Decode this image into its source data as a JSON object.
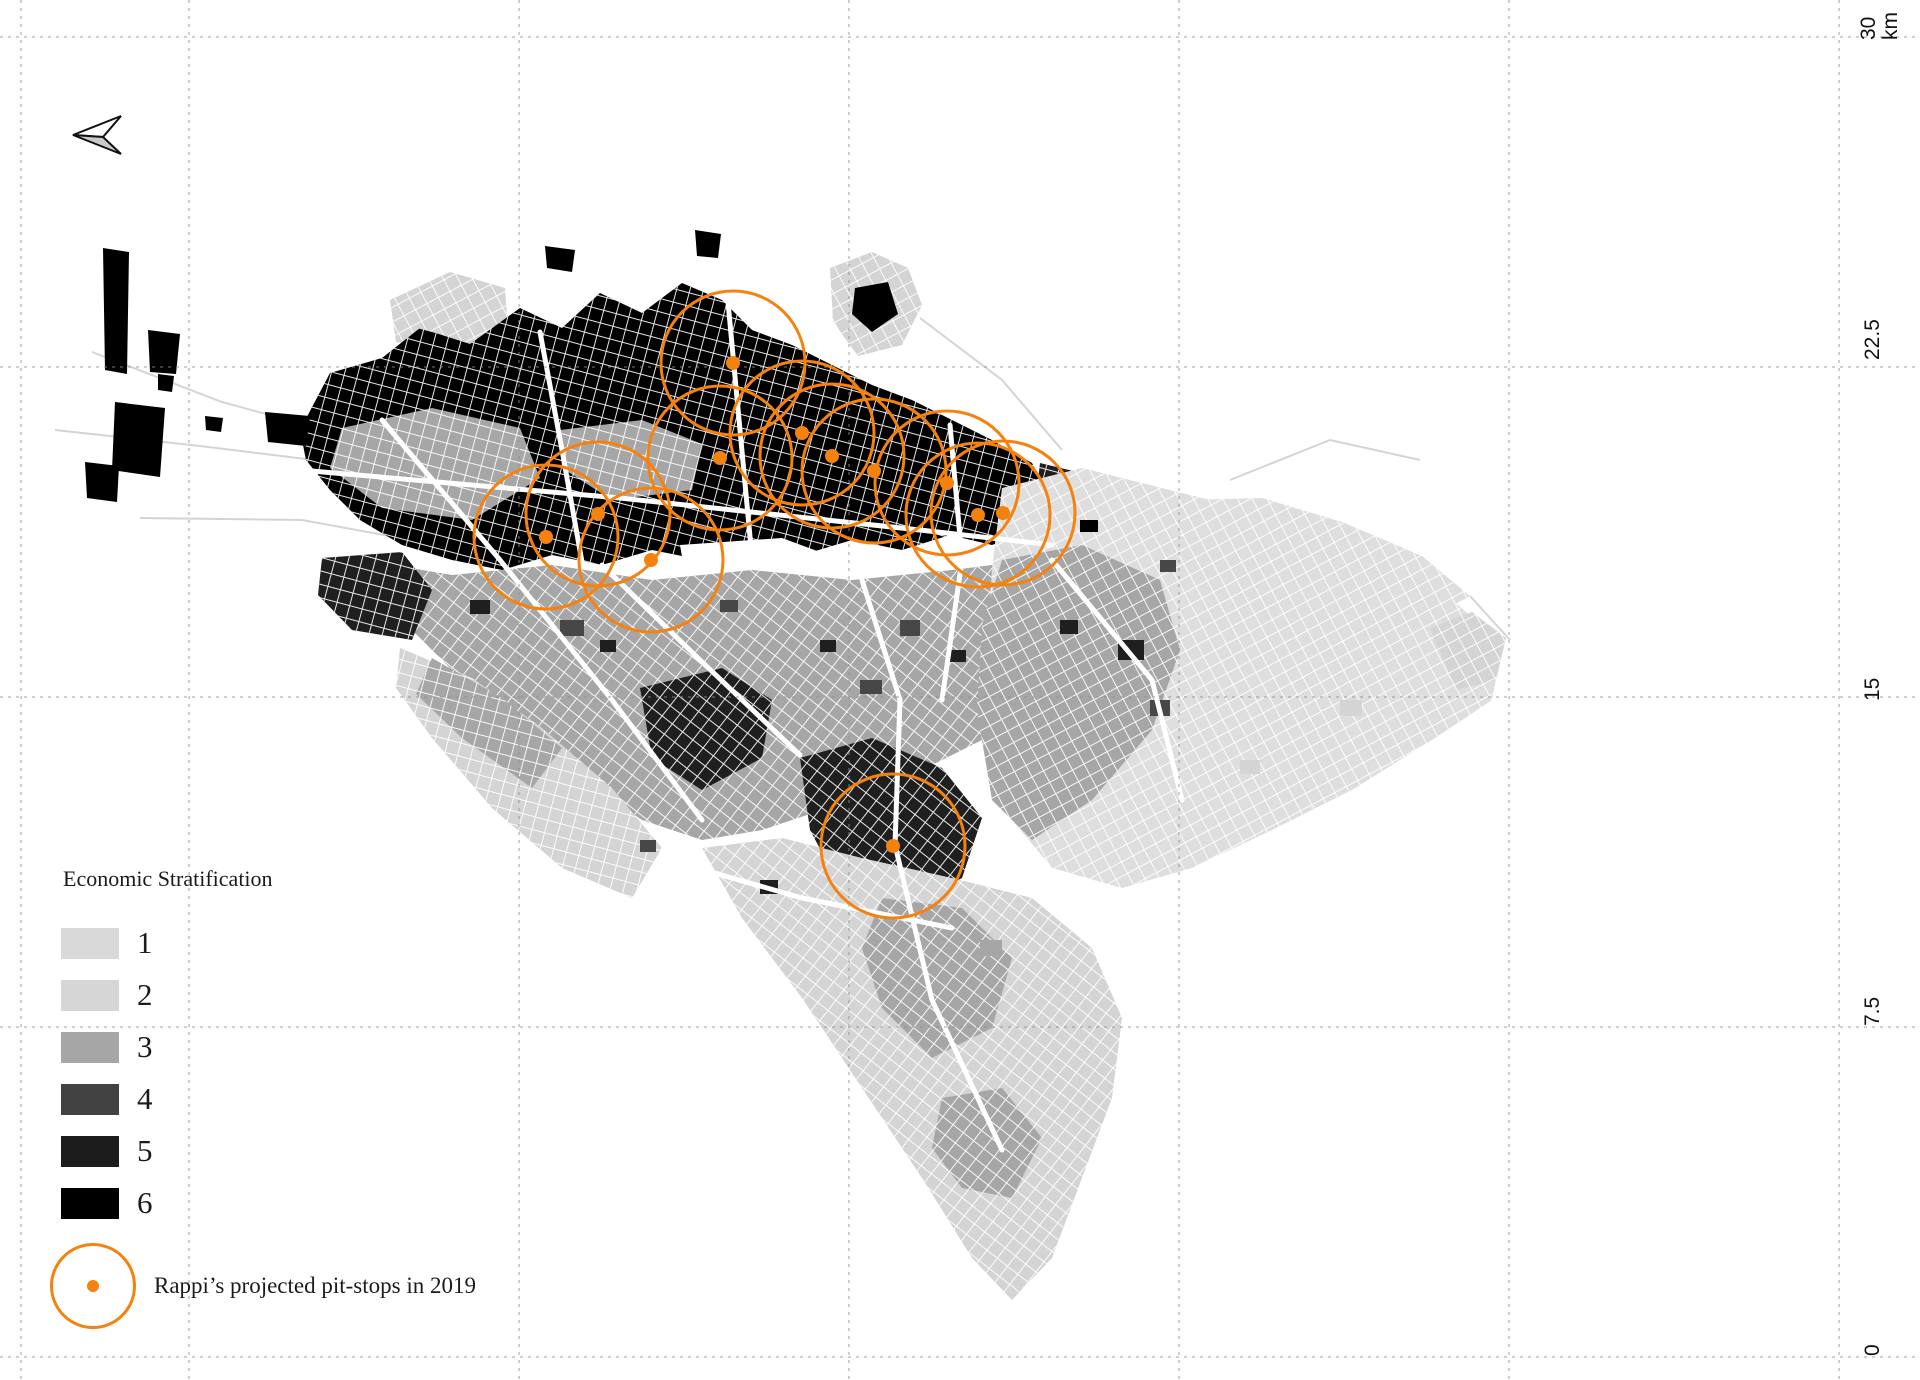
{
  "scale_bar": {
    "unit": "km",
    "ticks": [
      {
        "label": "30\nkm",
        "x": 1858,
        "y": 40
      },
      {
        "label": "22.5",
        "x": 1862,
        "y": 360
      },
      {
        "label": "15",
        "x": 1862,
        "y": 701
      },
      {
        "label": "7.5",
        "x": 1862,
        "y": 1026
      },
      {
        "label": "0",
        "x": 1862,
        "y": 1356
      }
    ]
  },
  "grid": {
    "color": "#8f8f8f",
    "dash": "3 5",
    "h_lines": [
      37,
      367,
      697,
      1027,
      1357
    ],
    "v_lines": [
      21,
      189,
      519,
      849,
      1179,
      1509,
      1839
    ]
  },
  "legend": {
    "title": "Economic Stratification",
    "strata": [
      {
        "label": "1",
        "color": "#d9d9d9"
      },
      {
        "label": "2",
        "color": "#d6d6d6"
      },
      {
        "label": "3",
        "color": "#a6a6a6"
      },
      {
        "label": "4",
        "color": "#424242"
      },
      {
        "label": "5",
        "color": "#1c1c1c"
      },
      {
        "label": "6",
        "color": "#000000"
      }
    ],
    "pitstop_label": "Rappi’s projected pit-stops in 2019"
  },
  "pit_stops": {
    "color": "#f5820f",
    "radius": 72,
    "dot_radius": 7,
    "stroke_width": 3,
    "points": [
      [
        733,
        363
      ],
      [
        802,
        433
      ],
      [
        720,
        458
      ],
      [
        832,
        456
      ],
      [
        874,
        471
      ],
      [
        947,
        483
      ],
      [
        1003,
        513
      ],
      [
        978,
        515
      ],
      [
        598,
        514
      ],
      [
        546,
        537
      ],
      [
        651,
        560
      ],
      [
        893,
        846
      ]
    ]
  },
  "north_arrow": {
    "upper": "73,135 121,116 103,137",
    "lower": "73,135 103,137 121,154",
    "fill_upper": "#ffffff",
    "fill_lower": "#c9c9c9",
    "stroke": "#111111"
  },
  "map": {
    "stratum_colors": {
      "0": "#ffffff",
      "1": "#dedede",
      "2": "#d4d4d4",
      "3": "#a6a6a6",
      "4": "#474747",
      "5": "#1f1f1f",
      "6": "#000000"
    },
    "districts": [
      {
        "s": 2,
        "pat": 1,
        "pts": "390,300 450,272 505,288 508,332 448,352 396,342"
      },
      {
        "s": 2,
        "pat": 1,
        "pts": "830,268 872,252 908,268 922,305 902,345 858,356 833,322"
      },
      {
        "s": 6,
        "pat": -1,
        "pts": "855,288 888,282 898,314 872,332 852,314"
      },
      {
        "s": 6,
        "pat": 0,
        "pts": "300,430 330,373 382,358 420,328 470,344 520,308 562,328 600,293 642,313 682,283 722,300 752,330 792,345 832,365 872,385 912,400 952,420 992,440 1032,463 1052,500 1032,530 992,545 950,535 902,550 852,540 802,555 752,545 702,560 652,550 602,565 552,555 502,570 452,560 402,545 360,520 330,490 306,460"
      },
      {
        "s": 5,
        "pat": 0,
        "pts": "1040,463 1102,478 1162,508 1212,538 1232,578 1202,620 1152,640 1102,620 1062,580 1032,532"
      },
      {
        "s": 3,
        "pat": 0,
        "pts": "342,428 432,408 520,428 540,478 472,520 382,508 330,468"
      },
      {
        "s": 3,
        "pat": 0,
        "pts": "560,430 642,420 702,444 692,490 612,500 562,468"
      },
      {
        "s": 0,
        "pat": -1,
        "pts": "680,545 782,538 882,575 872,635 772,660 692,615"
      },
      {
        "s": 3,
        "pat": 2,
        "pts": "362,560 452,575 552,565 652,580 752,570 852,580 952,570 1032,560 1082,600 1102,650 1062,700 1002,730 942,760 882,790 822,810 762,830 702,840 642,820 582,780 522,730 462,680 412,630 376,595"
      },
      {
        "s": 5,
        "pat": 2,
        "pts": "800,758 872,738 942,768 982,818 962,878 902,910 842,890 810,830"
      },
      {
        "s": 5,
        "pat": 2,
        "pts": "640,688 722,668 772,700 762,758 702,790 652,758"
      },
      {
        "s": 5,
        "pat": 0,
        "pts": "322,558 402,552 432,590 412,640 352,630 318,595"
      },
      {
        "s": 1,
        "pat": 1,
        "pts": "1002,488 1082,468 1162,488 1242,508 1322,538 1402,568 1462,608 1502,648 1492,700 1432,740 1352,790 1272,830 1192,868 1122,888 1052,868 1012,820 992,750 987,660 992,568"
      },
      {
        "s": 1,
        "pat": 1,
        "pts": "1180,500 1262,498 1342,522 1422,556 1470,596 1430,618 1352,600 1272,572 1208,540"
      },
      {
        "s": 3,
        "pat": 1,
        "pts": "1002,560 1082,545 1160,580 1180,650 1152,730 1092,800 1032,840 992,800 977,710 982,625"
      },
      {
        "s": 2,
        "pat": 2,
        "pts": "702,848 782,838 862,858 952,878 1032,898 1092,948 1122,1018 1112,1098 1082,1178 1052,1258 1012,1300 972,1258 922,1178 862,1088 802,998 742,918"
      },
      {
        "s": 3,
        "pat": 2,
        "pts": "882,898 962,908 1012,958 992,1028 932,1058 882,1008 862,948"
      },
      {
        "s": 3,
        "pat": 2,
        "pts": "942,1098 1002,1088 1042,1138 1012,1198 962,1188 932,1148"
      },
      {
        "s": 2,
        "pat": 0,
        "pts": "400,648 472,678 542,728 612,788 662,848 632,898 562,868 492,808 432,738 396,688"
      },
      {
        "s": 3,
        "pat": 0,
        "pts": "432,658 502,698 562,748 532,788 462,738 416,694"
      },
      {
        "s": 2,
        "pat": 1,
        "pts": "1430,628 1472,612 1506,638 1496,680 1456,690"
      },
      {
        "s": 6,
        "pat": -1,
        "pts": "103,248 129,252 127,374 105,370"
      },
      {
        "s": 6,
        "pat": -1,
        "pts": "148,330 180,334 176,374 150,372"
      },
      {
        "s": 6,
        "pat": -1,
        "pts": "158,374 174,376 172,392 158,390"
      },
      {
        "s": 6,
        "pat": -1,
        "pts": "115,402 165,408 160,477 112,470"
      },
      {
        "s": 6,
        "pat": -1,
        "pts": "85,462 119,466 117,502 87,498"
      },
      {
        "s": 6,
        "pat": -1,
        "pts": "265,412 310,416 306,446 268,442"
      },
      {
        "s": 6,
        "pat": -1,
        "pts": "205,416 223,418 221,432 206,430"
      },
      {
        "s": 6,
        "pat": -1,
        "pts": "695,230 721,234 718,258 697,256"
      },
      {
        "s": 6,
        "pat": -1,
        "pts": "545,246 575,250 572,272 547,268"
      }
    ],
    "blocks": [
      [
        1118,
        640,
        26,
        20,
        5
      ],
      [
        1150,
        700,
        20,
        16,
        4
      ],
      [
        1060,
        620,
        18,
        14,
        5
      ],
      [
        980,
        940,
        22,
        16,
        3
      ],
      [
        1160,
        560,
        16,
        12,
        4
      ],
      [
        760,
        880,
        18,
        14,
        5
      ],
      [
        640,
        840,
        16,
        12,
        4
      ],
      [
        1240,
        760,
        20,
        14,
        2
      ],
      [
        1340,
        700,
        22,
        16,
        2
      ],
      [
        470,
        600,
        20,
        14,
        5
      ],
      [
        560,
        620,
        24,
        16,
        4
      ],
      [
        600,
        640,
        16,
        12,
        5
      ],
      [
        900,
        620,
        20,
        16,
        4
      ],
      [
        950,
        650,
        16,
        12,
        5
      ],
      [
        1080,
        520,
        18,
        12,
        6
      ],
      [
        860,
        680,
        22,
        14,
        4
      ],
      [
        720,
        600,
        18,
        12,
        4
      ],
      [
        820,
        640,
        16,
        12,
        5
      ]
    ],
    "roads": [
      "300,470 620,498 920,530 1052,545",
      "540,332 562,450 582,562",
      "728,302 740,430 752,558",
      "950,425 962,560 942,700",
      "382,420 500,560 612,700 702,820",
      "1052,560 1152,680 1182,800",
      "862,580 900,700 895,845 932,1000 1002,1150",
      "662,858 802,898 952,928",
      "602,565 700,660 800,755"
    ],
    "rural_roads": [
      "55,430 200,446 362,466",
      "92,352 222,402 332,432",
      "140,518 302,520 422,542",
      "920,318 1002,380 1062,450",
      "1230,480 1330,440 1420,460",
      "1470,596 1510,640"
    ]
  }
}
